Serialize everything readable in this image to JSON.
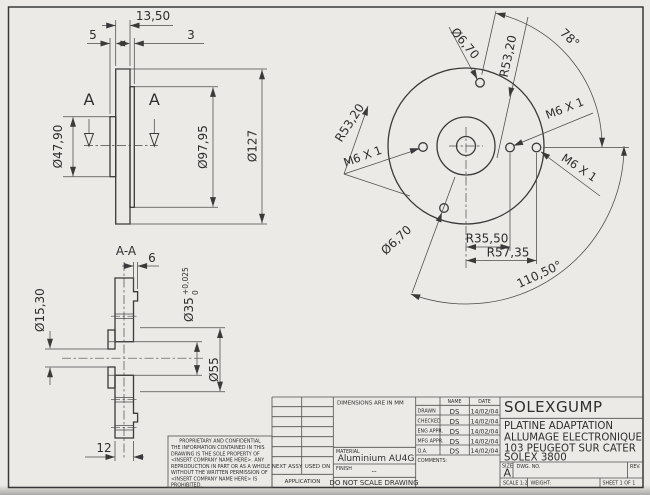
{
  "front_view": {
    "dim_13_50": "13,50",
    "dim_5": "5",
    "dim_3": "3",
    "dim_d47_90": "Ø47,90",
    "dim_d97_95": "Ø97,95",
    "dim_d127": "Ø127",
    "section_arrow_left": "A",
    "section_arrow_right": "A"
  },
  "section_view": {
    "label": "A-A",
    "dim_6": "6",
    "dim_12": "12",
    "dim_d35": "Ø35",
    "tol_upper": "+0,025",
    "tol_lower": "0",
    "dim_d55": "Ø55",
    "dim_d15_30": "Ø15,30"
  },
  "circular_view": {
    "dim_d6_70_top": "Ø6,70",
    "dim_d6_70_bottom": "Ø6,70",
    "dim_r53_20_left": "R53,20",
    "dim_r53_20_right": "R53,20",
    "dim_m6_left": "M6 X 1",
    "dim_m6_top_right": "M6 X 1",
    "dim_m6_bottom_right": "M6 X 1",
    "dim_angle_78": "78°",
    "dim_angle_110_50": "110,50°",
    "dim_r35_50": "R35,50",
    "dim_r57_35": "R57,35"
  },
  "title_block": {
    "dimensions_note": "DIMENSIONS ARE IN MM",
    "name_header": "NAME",
    "date_header": "DATE",
    "approvals": [
      {
        "label": "DRAWN",
        "name": "DS",
        "date": "14/02/04"
      },
      {
        "label": "CHECKED",
        "name": "DS",
        "date": "14/02/04"
      },
      {
        "label": "ENG APPR.",
        "name": "DS",
        "date": "14/02/04"
      },
      {
        "label": "MFG APPR.",
        "name": "DS",
        "date": "14/02/04"
      },
      {
        "label": "Q.A.",
        "name": "DS",
        "date": "14/02/04"
      }
    ],
    "comments_label": "COMMENTS:",
    "material_label": "MATERIAL",
    "material_value": "Aluminium AU4G",
    "finish_label": "FINISH",
    "finish_value": "--",
    "next_assy": "NEXT ASSY",
    "used_on": "USED ON",
    "application": "APPLICATION",
    "do_not_scale": "DO NOT SCALE DRAWING",
    "company": "SOLEXGUMP",
    "title_lines": [
      "PLATINE ADAPTATION",
      "ALLUMAGE ELECTRONIQUE",
      "103 PEUGEOT SUR CATER",
      "SOLEX 3800"
    ],
    "size_label": "SIZE",
    "size_value": "A",
    "dwg_label": "DWG. NO.",
    "rev_label": "REV.",
    "scale_label": "SCALE 1:2",
    "weight_label": "WEIGHT:",
    "sheet_label": "SHEET 1 OF 1"
  },
  "proprietary": {
    "heading": "PROPRIETARY AND CONFIDENTIAL",
    "lines": [
      "THE INFORMATION CONTAINED IN THIS",
      "DRAWING IS THE SOLE PROPERTY OF",
      "<INSERT COMPANY NAME HERE>.  ANY",
      "REPRODUCTION IN PART OR AS A WHOLE",
      "WITHOUT THE WRITTEN PERMISSION OF",
      "<INSERT COMPANY NAME HERE> IS",
      "PROHIBITED."
    ]
  }
}
